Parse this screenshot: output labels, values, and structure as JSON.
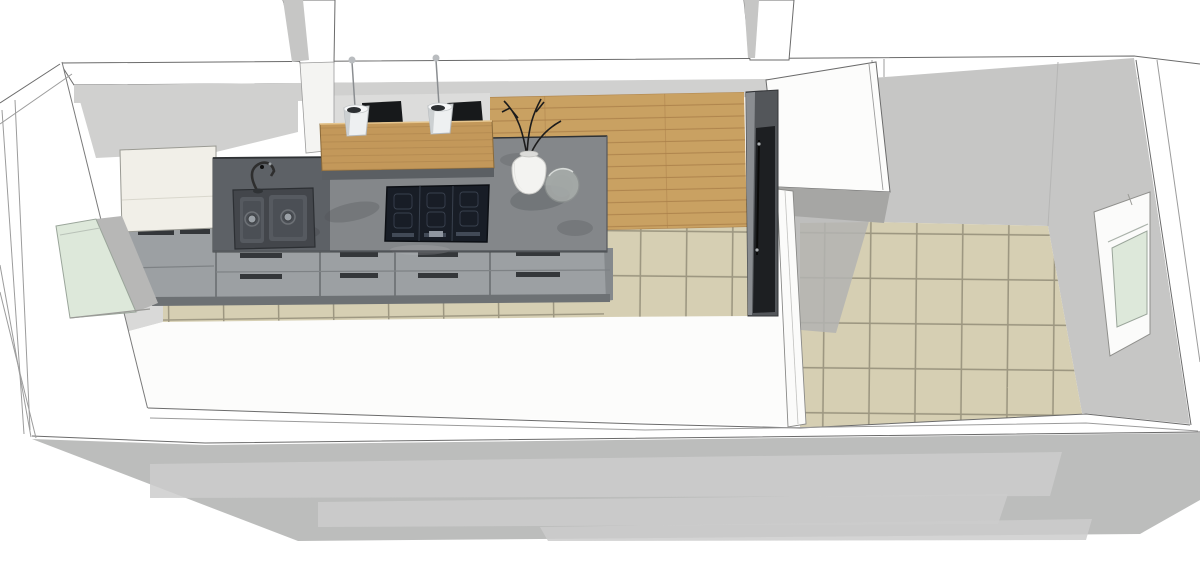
{
  "meta": {
    "description": "3D cutaway render of a long rectangular interior seen from above: a galley kitchen with island bar on the left and a separate beige-tiled room on the right",
    "view": "perspective top-down cutaway, no UI chrome, no visible text"
  },
  "colors": {
    "wall_white": "#ffffff",
    "wall_outline": "#6b6b6b",
    "wall_outline_soft": "#9c9c9c",
    "wall_gray": "#c6c6c5",
    "wall_gray_light": "#d0d0cf",
    "behind_bar_gray": "#dcdcdb",
    "floor_white": "#fcfcfb",
    "corner_shadow": "#d9d9d8",
    "tile_beige": "#d6cfb3",
    "tile_grout": "#9d9781",
    "wood_floor": "#c9a162",
    "wood_line": "#a87d46",
    "bar_wood": "#c3985a",
    "bar_edge": "#8a6a3a",
    "counter_gray": "#84878a",
    "counter_dark": "#5d6166",
    "counter_blotch": "#4f5357",
    "counter_edge": "#2e3134",
    "cabinet_gray": "#9ca0a3",
    "cabinet_gap": "#74787b",
    "cabinet_line": "#7e8285",
    "handle_slot": "#34373a",
    "cabinet_shadow": "#6d7174",
    "cream_cabinet": "#f1efe8",
    "cooktop_black": "#181d26",
    "cooktop_zone": "#39414e",
    "sink_outer": "#43464b",
    "sink_bowl": "#565a60",
    "sink_inner": "#4b4f55",
    "drain_silver": "#9aa0a6",
    "fridge_body": "#53565a",
    "fridge_panel": "#1d1f22",
    "fridge_edge": "#909497",
    "closet_face": "#a6a6a4",
    "shadow_on_tile": "#b3b3b1",
    "stool_black": "#17191b",
    "pendant_white": "#eef0f1",
    "pendant_shade": "#ccd0d2",
    "pendant_hole": "#2c2f32",
    "cord_gray": "#8a8d90",
    "glass_green": "#dde8da",
    "glass_frame": "#9aa59a",
    "reveal_gray": "#b7b7b6",
    "vase_white": "#f3f3f1",
    "twig_black": "#1c1c1c",
    "bowl_glass": "#aeb3b0",
    "ground_shadow": "#bcbdbc",
    "ground_light": "#cdcdcc"
  },
  "scene": {
    "rooms": [
      {
        "name": "kitchen",
        "floors": [
          "white",
          "beige-tile-strip",
          "wood-patch"
        ]
      },
      {
        "name": "side-room",
        "floors": [
          "beige-tile"
        ]
      }
    ],
    "objects": [
      "double-bowl-sink",
      "faucet",
      "induction-cooktop",
      "base-cabinet-run",
      "tall-cream-cabinet",
      "wood-bar-counter",
      "bar-stool",
      "bar-stool",
      "pendant-lamp",
      "pendant-lamp",
      "vase-with-twigs",
      "glass-bowl",
      "tall-dark-fridge-column",
      "white-closet-block",
      "partition-wall",
      "left-window",
      "right-window"
    ]
  }
}
